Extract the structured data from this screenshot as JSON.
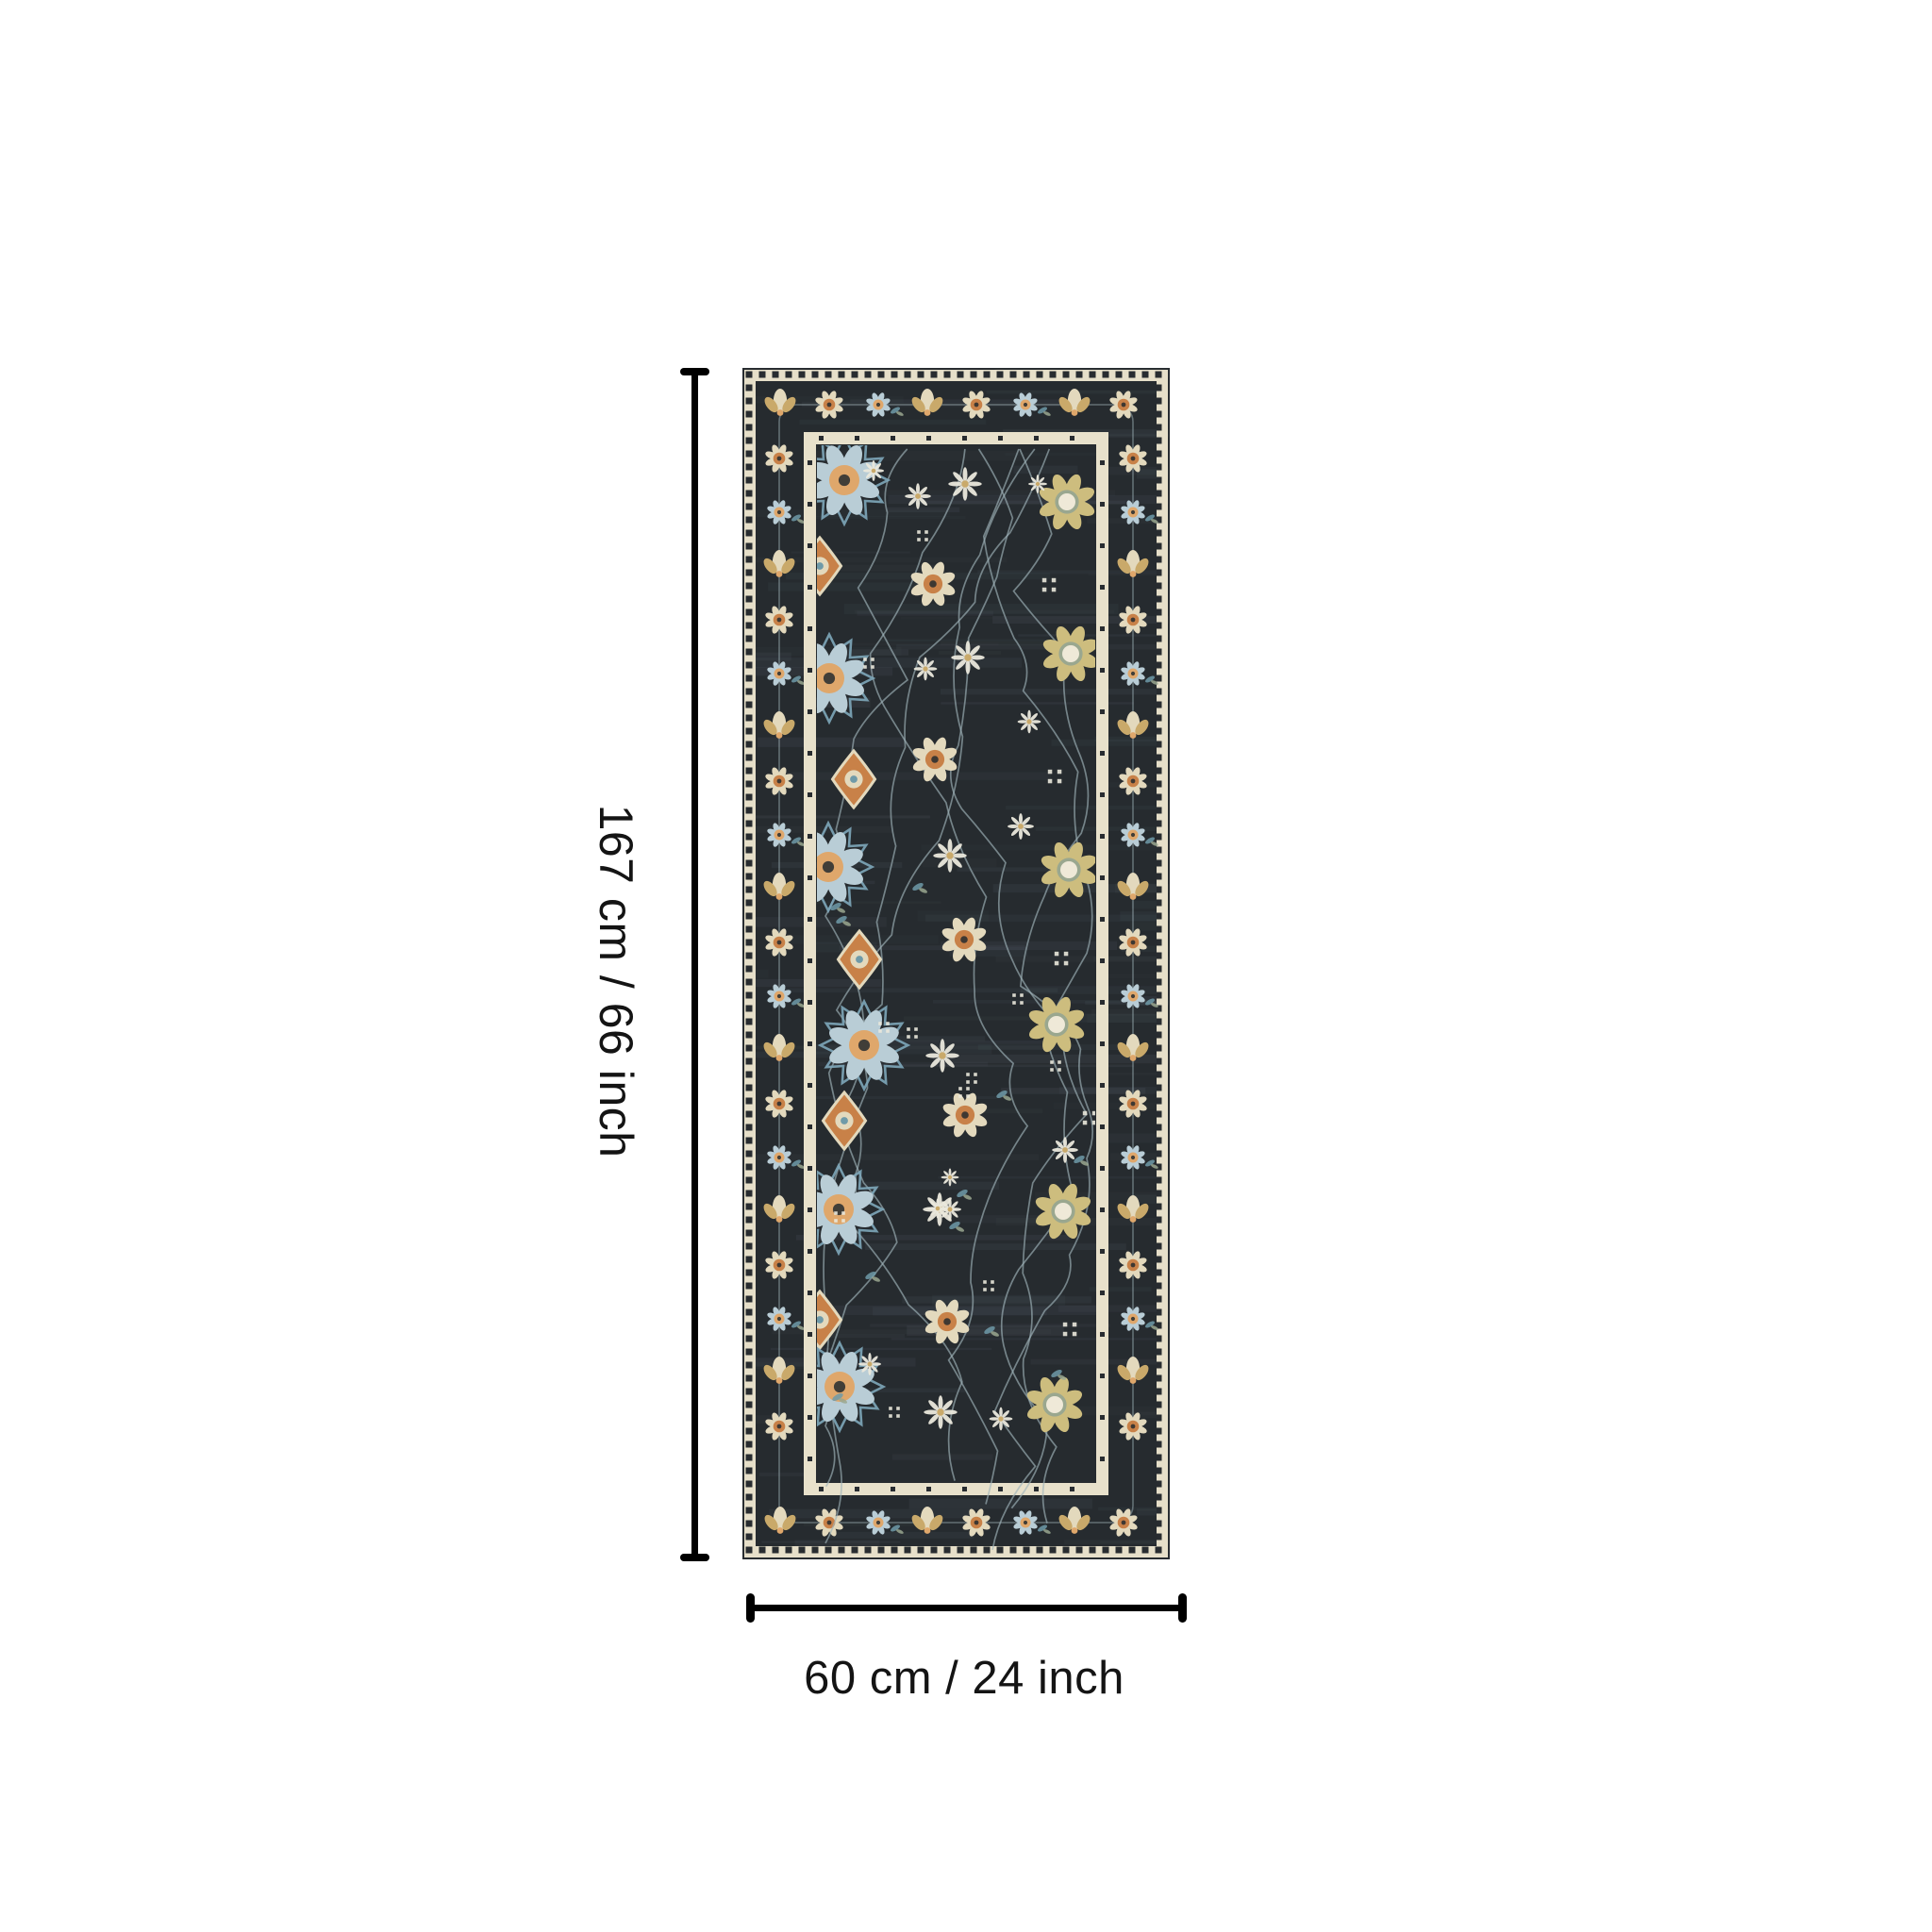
{
  "page": {
    "background_color": "#ffffff"
  },
  "product": {
    "type": "runner-rug",
    "description": "Dark charcoal distressed oriental floral runner rug with cream, tan, orange and light blue flower motifs, checkered cream outer edge and cream inner frame"
  },
  "dimensions": {
    "height_label": "167 cm / 66 inch",
    "width_label": "60 cm / 24 inch",
    "height_cm": 167,
    "height_inch": 66,
    "width_cm": 60,
    "width_inch": 24,
    "line_color": "#000000",
    "label_color": "#141414"
  },
  "rug": {
    "seed": 20,
    "palette": {
      "field": "#262b2f",
      "streak": "#566069",
      "checker_cream": "#e6dfc9",
      "checker_dark": "#282c30",
      "frame_cream": "#e8e1cb",
      "cream": "#e3d9bd",
      "ivory": "#efe9d8",
      "tan": "#c9a96a",
      "gold": "#cdbd7e",
      "orange": "#c88148",
      "peach": "#dfa76b",
      "blue": "#7ea7ba",
      "light_blue": "#b9cdd6",
      "teal": "#6f9aa8",
      "sage": "#9aa78f",
      "vine": "#9fb3ba",
      "white": "#eae8dc"
    }
  }
}
